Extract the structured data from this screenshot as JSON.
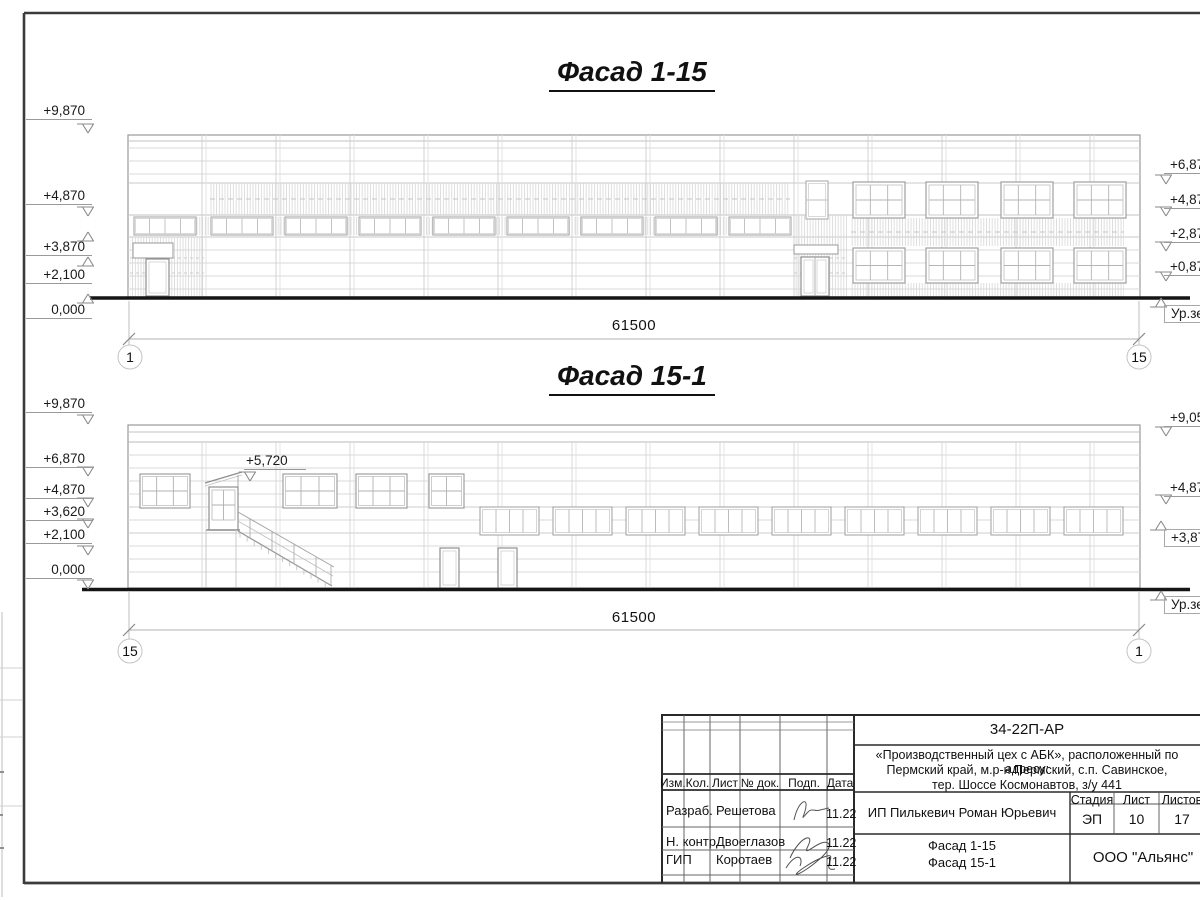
{
  "palette": {
    "paper": "#ffffff",
    "ink": "#111111",
    "drawing_line": "#c8c8c8"
  },
  "facade1": {
    "title": "Фасад 1-15",
    "dimension": "61500",
    "axis_left": "1",
    "axis_right": "15",
    "marks_left": [
      "+9,870",
      "+4,870",
      "+3,870",
      "+2,100",
      "0,000"
    ],
    "marks_right": [
      "+6,87",
      "+4,87",
      "+2,87",
      "+0,87"
    ],
    "ground_label": "Ур.зе"
  },
  "facade2": {
    "title": "Фасад 15-1",
    "dimension": "61500",
    "axis_left": "15",
    "axis_right": "1",
    "marks_left": [
      "+9,870",
      "+6,870",
      "+4,870",
      "+3,620",
      "+2,100",
      "0,000"
    ],
    "marks_right": [
      "+9,05",
      "+4,87",
      "+3,87"
    ],
    "ground_label": "Ур.зе",
    "annotation": "+5,720"
  },
  "titleblock": {
    "code": "34-22П-АР",
    "project_line1": "«Производственный цех с АБК», расположенный по адресу:",
    "project_line2": "Пермский край, м.р-н Пермский, с.п. Савинское,",
    "project_line3": "тер. Шоссе Космонавтов, з/у 441",
    "col_izm": "Изм.",
    "col_kol": "Кол.",
    "col_list": "Лист",
    "col_ndok": "№ док.",
    "col_podp": "Подп.",
    "col_data": "Дата",
    "row1_role": "Разраб.",
    "row1_name": "Решетова",
    "row1_date": "11.22",
    "row2_role": "Н. контр.",
    "row2_name": "Двоеглазов",
    "row2_date": "11.22",
    "row3_role": "ГИП",
    "row3_name": "Коротаев",
    "row3_date": "11.22",
    "client": "ИП Пилькевич Роман Юрьевич",
    "stage_label": "Стадия",
    "sheet_label": "Лист",
    "sheets_label": "Листов",
    "stage": "ЭП",
    "sheet_no": "10",
    "sheets_total": "17",
    "doc_title_line1": "Фасад 1-15",
    "doc_title_line2": "Фасад 15-1",
    "org": "ООО \"Альянс\""
  }
}
